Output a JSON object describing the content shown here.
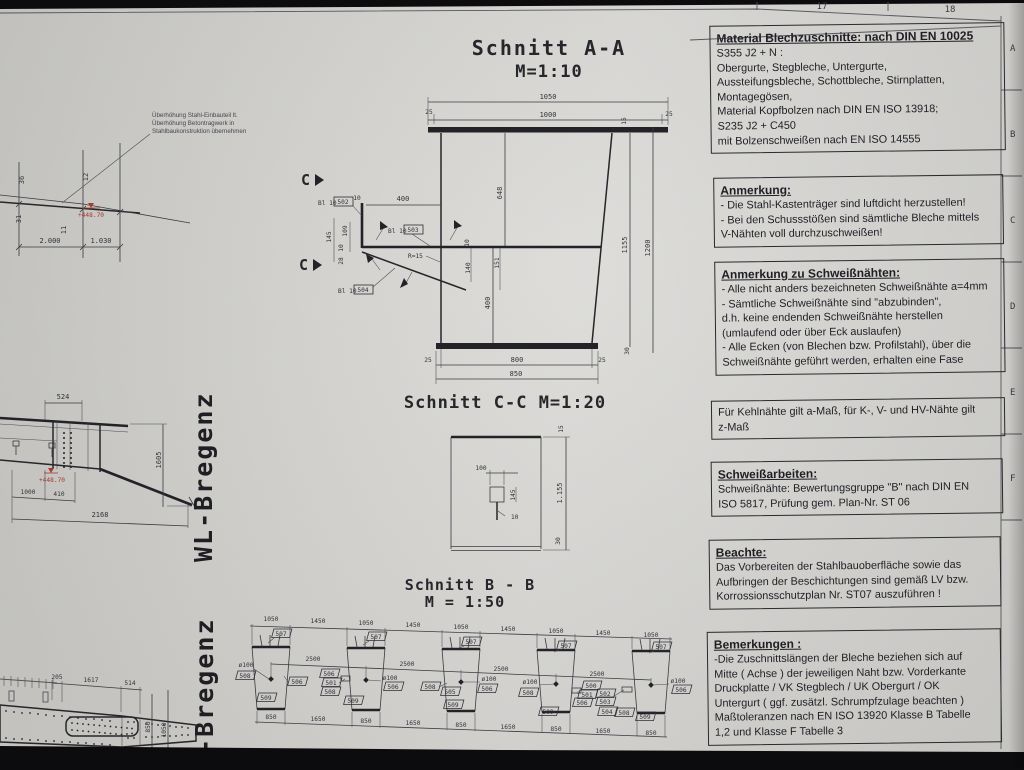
{
  "colors": {
    "paper": "#d6d5d2",
    "line": "#26262b",
    "accent_red": "#a63a30"
  },
  "margin": {
    "numbers": [
      "17",
      "18"
    ],
    "letters": [
      "A",
      "B",
      "C",
      "D",
      "E",
      "F"
    ]
  },
  "watermarks": {
    "upper": "WL-Bregenz",
    "lower": "WL-Bregenz"
  },
  "camber": {
    "note": [
      "Überhöhung Stahl-Einbauteil lt.",
      "Überhöhung Betontragwerk in",
      "Stahlbaukonstruktion übernehmen"
    ],
    "d36": "36",
    "d12": "12",
    "d31": "31",
    "d11": "11",
    "d2000": "2.000",
    "d1030": "1.030",
    "level": "+448.70"
  },
  "aa": {
    "title": "Schnitt A-A",
    "scale": "M=1:10",
    "d1050": "1050",
    "d1000": "1000",
    "d25l": "25",
    "d25r": "25",
    "d15": "15",
    "d1155": "1155",
    "d1200": "1200",
    "d30": "30",
    "d25bl": "25",
    "d800": "800",
    "d25br": "25",
    "d850": "850",
    "d648": "648",
    "d400v": "400",
    "mat": "Bl 10",
    "p502": "502",
    "p503": "503",
    "p504": "504",
    "r15": "R=15",
    "d400": "400",
    "d10": "10",
    "left": [
      "145",
      "109",
      "10",
      "28"
    ],
    "right": [
      "10",
      "140",
      "151"
    ],
    "marker": "C"
  },
  "cc": {
    "title": "Schnitt C-C M=1:20",
    "d100": "100",
    "d145": "145",
    "d10": "10",
    "d15": "15",
    "d1155": "1.155",
    "d30": "30"
  },
  "bb": {
    "title": "Schnitt B - B",
    "scale": "M = 1:50",
    "top": [
      "1050",
      "1450",
      "1050",
      "1450",
      "1050",
      "1450",
      "1050",
      "1450",
      "1050"
    ],
    "mid": [
      "2500",
      "2500",
      "2500",
      "2500"
    ],
    "bot": [
      "850",
      "1650",
      "850",
      "1650",
      "850",
      "1650",
      "850",
      "1650",
      "850"
    ],
    "traps": [
      {
        "top": "507",
        "dia": "ø100",
        "l1": "508",
        "r1": "506",
        "bot": "509"
      },
      {
        "top": "507",
        "dia": "ø100",
        "l1": "506",
        "l2": "501",
        "l3": "508",
        "r1": "506",
        "bot": "509"
      },
      {
        "top": "507",
        "dia": "ø100",
        "l1": "508",
        "l2": "505",
        "r1": "506",
        "bot": "509"
      },
      {
        "top": "507",
        "dia": "ø100",
        "l1": "508",
        "r1": "500",
        "r2": "501",
        "r3": "506",
        "bot": "509"
      },
      {
        "top": "507",
        "dia": "ø100",
        "l1": "502",
        "l2": "503",
        "l3": "504",
        "l4": "508",
        "r1": "506",
        "bot": "509"
      }
    ]
  },
  "mid": {
    "d524": "524",
    "d1605": "1605",
    "d1000": "1000",
    "d410": "410",
    "d2168": "2168",
    "level": "+448.70"
  },
  "plan": {
    "d205": "205",
    "d1617": "1617",
    "d514": "514",
    "d850": "850",
    "d1050": "1050"
  },
  "notes": [
    {
      "title": "Material Blechzuschnitte: nach DIN EN 10025",
      "lines": [
        "S355 J2 + N :",
        "Obergurte, Stegbleche, Untergurte,",
        "Aussteifungsbleche, Schottbleche, Stirnplatten,",
        "Montagegösen,",
        "Material Kopfbolzen nach DIN EN ISO 13918;",
        "S235 J2 + C450",
        "mit Bolzenschweißen nach EN ISO 14555"
      ]
    },
    {
      "title": "Anmerkung:",
      "lines": [
        "- Die Stahl-Kastenträger sind luftdicht herzustellen!",
        "- Bei den Schussstößen sind sämtliche Bleche mittels",
        "V-Nähten voll durchzuschweißen!"
      ]
    },
    {
      "title": "Anmerkung zu Schweißnähten:",
      "lines": [
        "- Alle nicht anders bezeichneten Schweißnähte a=4mm",
        "- Sämtliche Schweißnähte sind  \"abzubinden\",",
        "d.h. keine endenden Schweißnähte herstellen",
        " (umlaufend oder über Eck auslaufen)",
        "- Alle Ecken (von Blechen bzw. Profilstahl), über die",
        "Schweißnähte geführt werden, erhalten eine Fase"
      ]
    },
    {
      "title": "",
      "lines": [
        "Für Kehlnähte gilt a-Maß, für K-, V- und HV-Nähte gilt",
        "z-Maß"
      ]
    },
    {
      "title": "Schweißarbeiten:",
      "lines": [
        "Schweißnähte: Bewertungsgruppe \"B\" nach DIN EN",
        "ISO 5817, Prüfung gem. Plan-Nr. ST 06"
      ]
    },
    {
      "title": "Beachte:",
      "lines": [
        "Das Vorbereiten der Stahlbauoberfläche sowie das",
        "Aufbringen der Beschichtungen sind gemäß LV bzw.",
        "Korrossionsschutzplan Nr. ST07  auszuführen !"
      ]
    },
    {
      "title": "Bemerkungen :",
      "lines": [
        "-Die Zuschnittslängen der Bleche beziehen sich auf",
        "Mitte ( Achse ) der jeweiligen Naht bzw. Vorderkante",
        "Druckplatte / VK Stegblech / UK Obergurt / OK",
        "Untergurt  ( ggf. zusätzl. Schrumpfzulage beachten )",
        "Maßtoleranzen nach EN ISO 13920 Klasse B Tabelle",
        "1,2 und Klasse F Tabelle 3"
      ]
    }
  ]
}
